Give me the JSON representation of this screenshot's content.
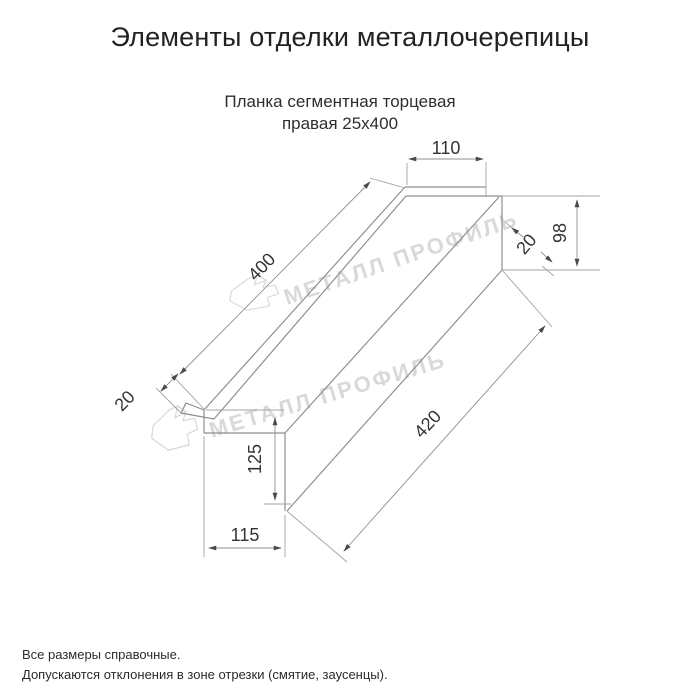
{
  "page": {
    "title": "Элементы отделки металлочерепицы",
    "subtitle_line1": "Планка сегментная торцевая",
    "subtitle_line2": "правая 25х400",
    "footer_note1": "Все размеры справочные.",
    "footer_note2": "Допускаются отклонения в зоне отрезки (смятие, заусенцы)."
  },
  "watermark": {
    "brand": "МЕТАЛЛ ПРОФИЛЬ",
    "color": "#d9d9d9"
  },
  "drawing": {
    "part_name": "Планка сегментная торцевая правая 25х400",
    "view": "isometric technical line drawing",
    "dimensions": {
      "top_flange_width_mm": "110",
      "end_height_mm": "98",
      "end_hem_mm": "20",
      "top_length_mm": "400",
      "left_hem_mm": "20",
      "face_height_mm": "125",
      "bottom_width_mm": "115",
      "bottom_length_mm": "420"
    },
    "colors": {
      "object_line": "#8f8f8f",
      "dimension_line": "#a3a3a3",
      "dimension_text": "#333333",
      "arrow": "#4a4a4a"
    }
  }
}
